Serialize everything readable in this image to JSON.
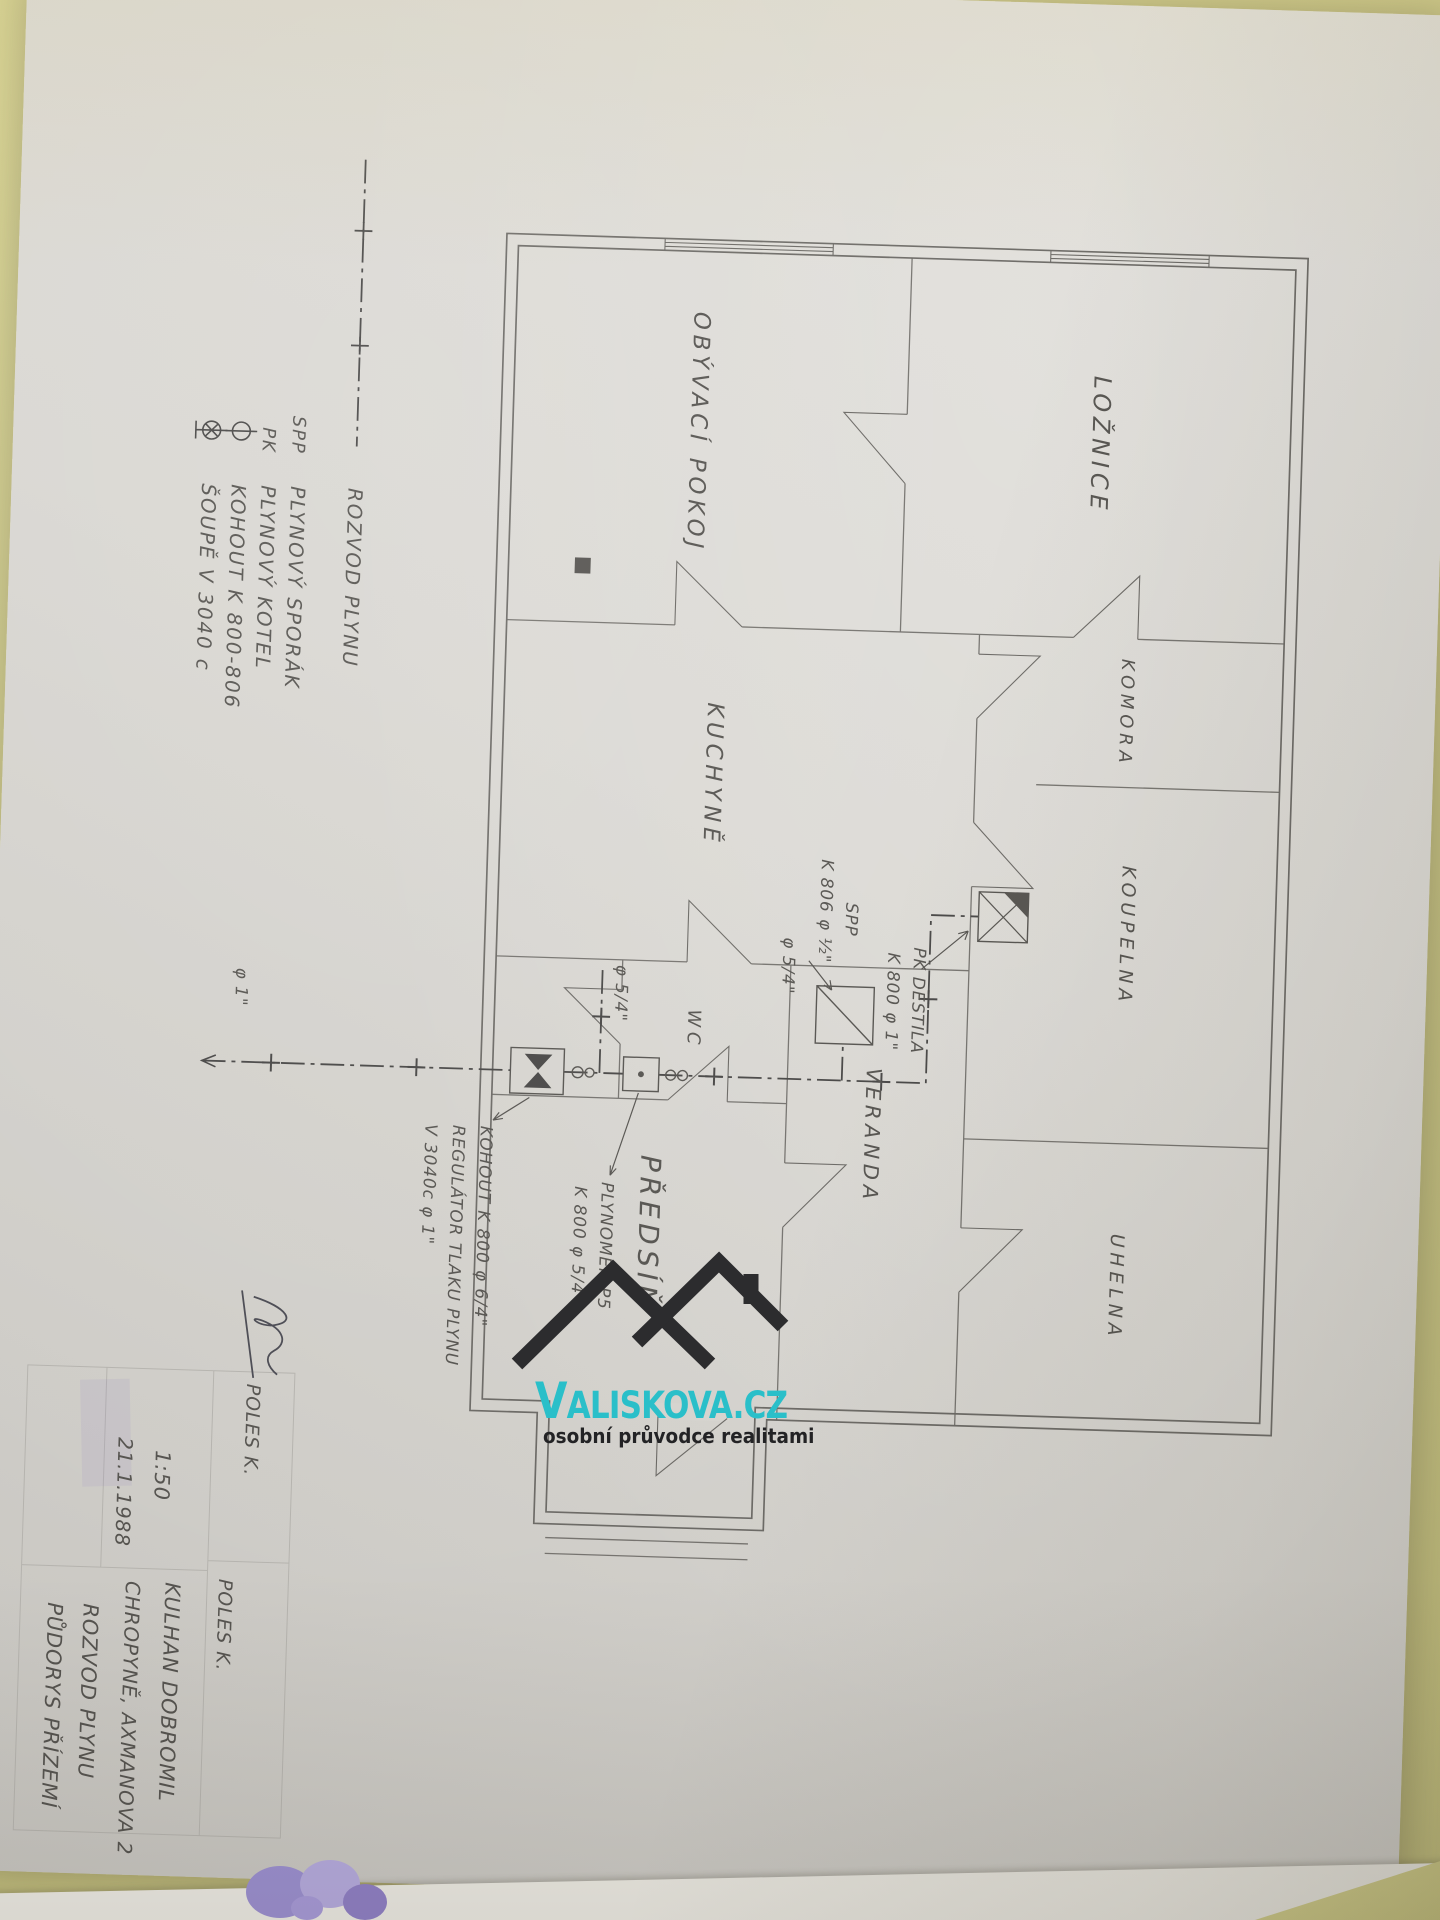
{
  "colors": {
    "brand_teal": "#2abfc9",
    "desk_background": "#d6d28c",
    "paper": "#d9d7d2",
    "pencil_line": "#63615d"
  },
  "watermark": {
    "brand_initial": "V",
    "brand_rest": "ALISKOVA.CZ",
    "tagline": "osobní průvodce realitami"
  },
  "legend": {
    "line_label": "ROZVOD PLYNU",
    "rows": [
      {
        "symbol": "SPP",
        "label": "PLYNOVÝ SPORÁK"
      },
      {
        "symbol": "PK",
        "label": "PLYNOVÝ KOTEL"
      },
      {
        "symbol": "",
        "label": "KOHOUT K 800-806"
      },
      {
        "symbol": "",
        "label": "ŠOUPĚ V 3040 c"
      }
    ]
  },
  "rooms": [
    {
      "label": "LOŽNICE"
    },
    {
      "label": "OBÝVACÍ POKOJ"
    },
    {
      "label": "KOMORA"
    },
    {
      "label": "KOUPELNA"
    },
    {
      "label": "UHELNA"
    },
    {
      "label": "VERANDA"
    },
    {
      "label": "KUCHYNĚ"
    },
    {
      "label": "WC"
    },
    {
      "label": "PŘEDSÍŇ"
    }
  ],
  "annotations": {
    "stove_1": "SPP",
    "stove_2": "K 806 φ ½\"",
    "boiler_1": "PK DESTILA",
    "boiler_2": "K 800 φ 1\"",
    "meter_1": "PLYNOMĚR P5",
    "meter_2": "K 800 φ 5/4\"",
    "valve": "KOHOUT K 800 φ 6/4\"",
    "regulator": "REGULÁTOR TLAKU PLYNU",
    "gate": "V 3040c φ 1\"",
    "dia_54_a": "φ 5/4\"",
    "dia_54_b": "φ 5/4\"",
    "dia_1": "φ 1\""
  },
  "title_block": {
    "scale": "1:50",
    "date": "21.1.1988",
    "drafted_by": "POLES K.",
    "checked_by": "POLES K.",
    "client": "KULHAN DOBROMIL",
    "address": "CHROPYNĚ, AXMANOVA 2",
    "drawing_title": "ROZVOD PLYNU",
    "sheet_title": "PŮDORYS PŘÍZEMÍ"
  }
}
